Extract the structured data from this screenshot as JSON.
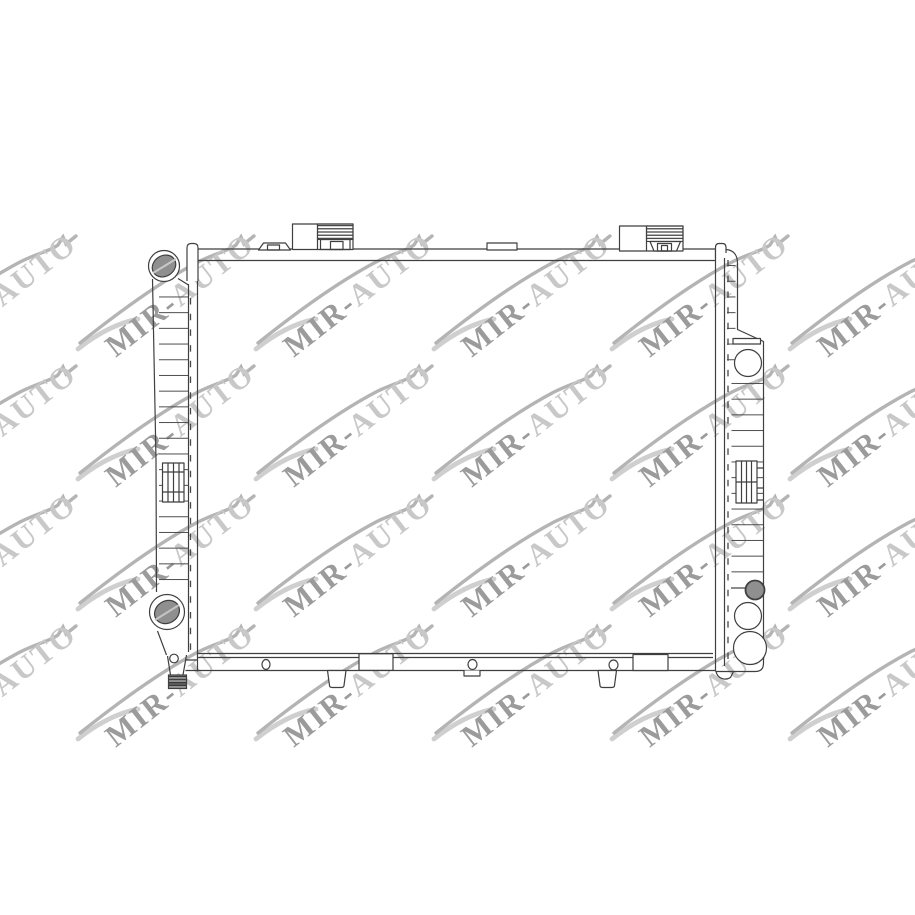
{
  "image": {
    "type": "product-technical-line-drawing",
    "subject": "automotive radiator, rear view",
    "background_color": "#ffffff",
    "line_color": "#3f3f3f",
    "port_fill_color": "#8f8f8f"
  },
  "watermark": {
    "part1": "MIR-",
    "part2": "AUTO",
    "color_dark": "#9b9b9b",
    "color_light": "#c8c8c8"
  }
}
